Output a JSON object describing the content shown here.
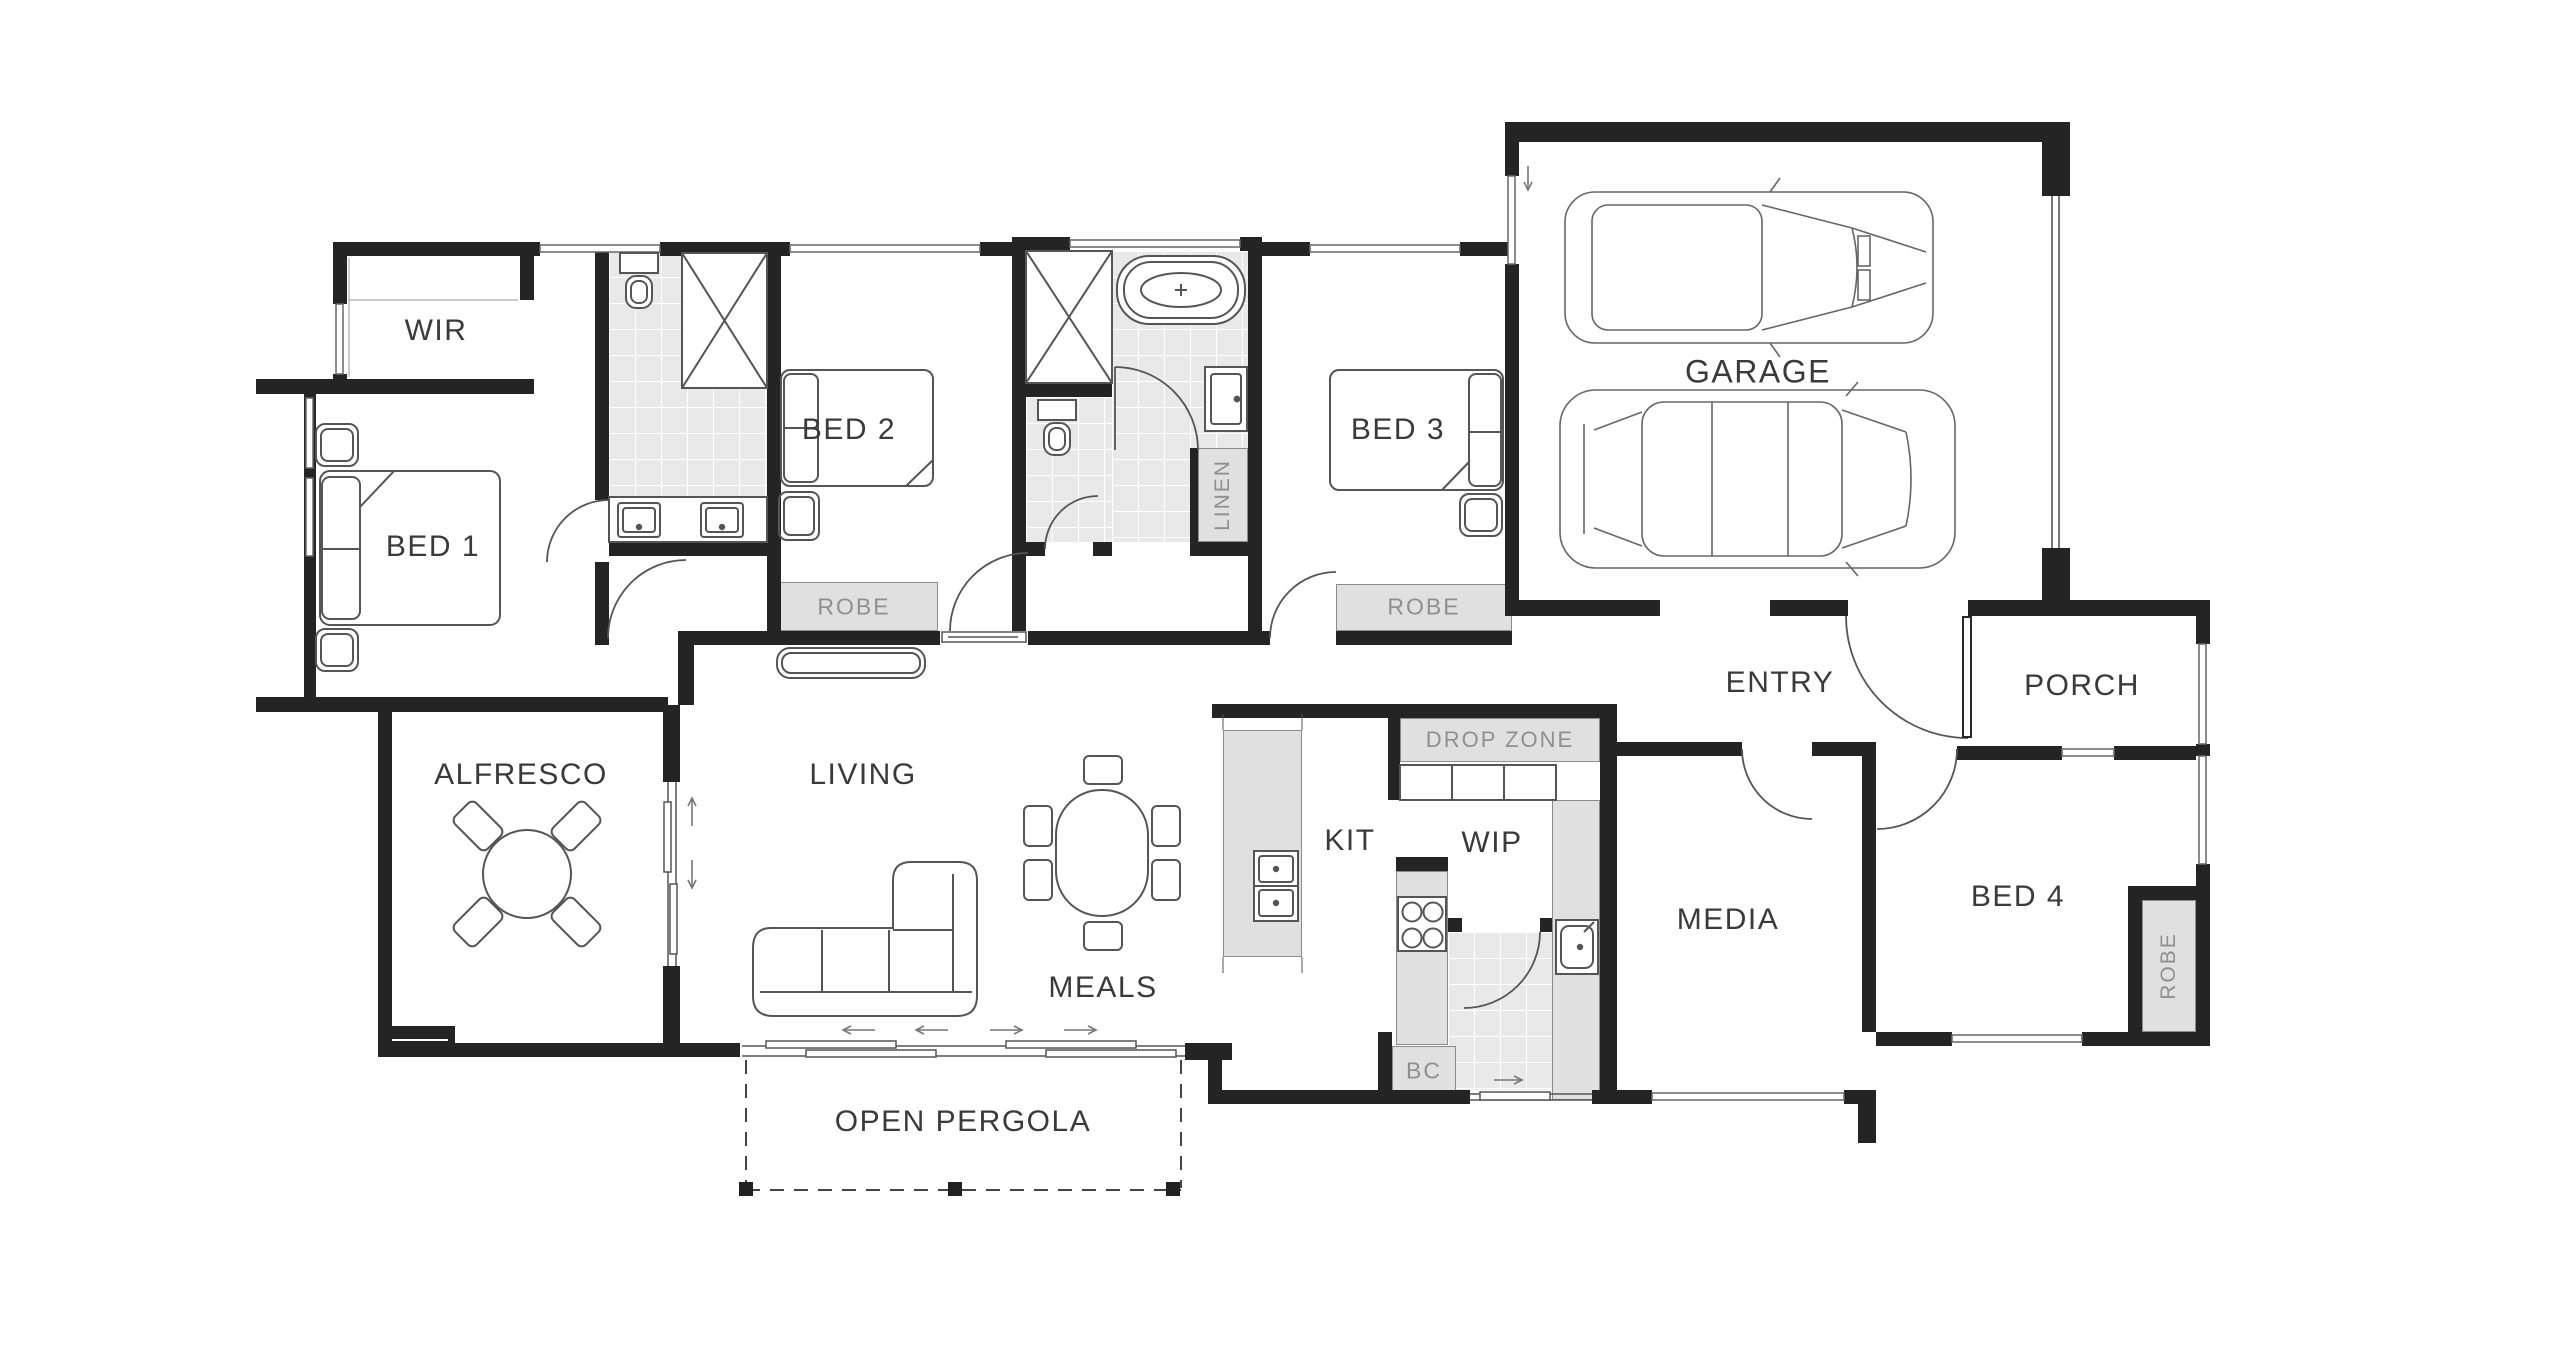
{
  "title": "Single storey house floor plan",
  "colors": {
    "wall": "#242424",
    "tile_floor": "#e9e9e9",
    "storage_fill": "#e0e0e0",
    "room_label": "#3a3a3a",
    "storage_label": "#8f8f8f",
    "linework": "#555555"
  },
  "rooms": {
    "wir": {
      "label": "WIR"
    },
    "bed1": {
      "label": "BED 1"
    },
    "bed2": {
      "label": "BED 2"
    },
    "bed3": {
      "label": "BED 3"
    },
    "bed4": {
      "label": "BED 4"
    },
    "garage": {
      "label": "GARAGE"
    },
    "entry": {
      "label": "ENTRY"
    },
    "porch": {
      "label": "PORCH"
    },
    "alfresco": {
      "label": "ALFRESCO"
    },
    "living": {
      "label": "LIVING"
    },
    "meals": {
      "label": "MEALS"
    },
    "kitchen": {
      "label": "KIT"
    },
    "wip": {
      "label": "WIP"
    },
    "media": {
      "label": "MEDIA"
    },
    "pergola": {
      "label": "OPEN PERGOLA"
    }
  },
  "storage": {
    "robe2": "ROBE",
    "robe3": "ROBE",
    "robe4": "ROBE",
    "linen": "LINEN",
    "drop_zone": "DROP ZONE",
    "bc": "BC"
  }
}
